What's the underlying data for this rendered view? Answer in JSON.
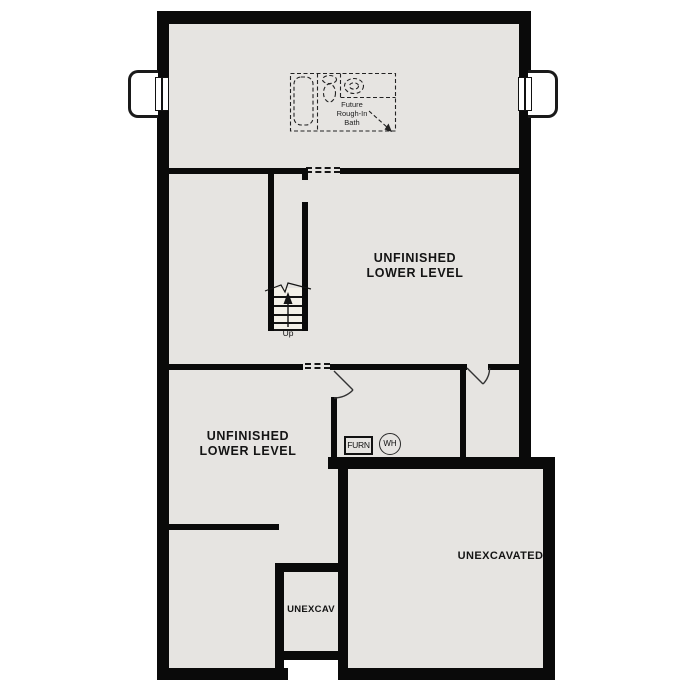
{
  "title": "Lower Level Floor Plan",
  "colors": {
    "floor": "#e6e4e1",
    "wall": "#0a0a0a",
    "background": "#ffffff",
    "line": "#222222"
  },
  "rooms": {
    "upper_unfinished": {
      "line1": "UNFINISHED",
      "line2": "LOWER LEVEL"
    },
    "lower_unfinished": {
      "line1": "UNFINISHED",
      "line2": "LOWER LEVEL"
    },
    "unexcavated_large": {
      "label": "UNEXCAVATED"
    },
    "unexcavated_small": {
      "label": "UNEXCAV"
    }
  },
  "bath": {
    "line1": "Future",
    "line2": "Rough-In",
    "line3": "Bath"
  },
  "stairs": {
    "up": "Up"
  },
  "equipment": {
    "furnace": "FURN",
    "water_heater": "WH"
  }
}
